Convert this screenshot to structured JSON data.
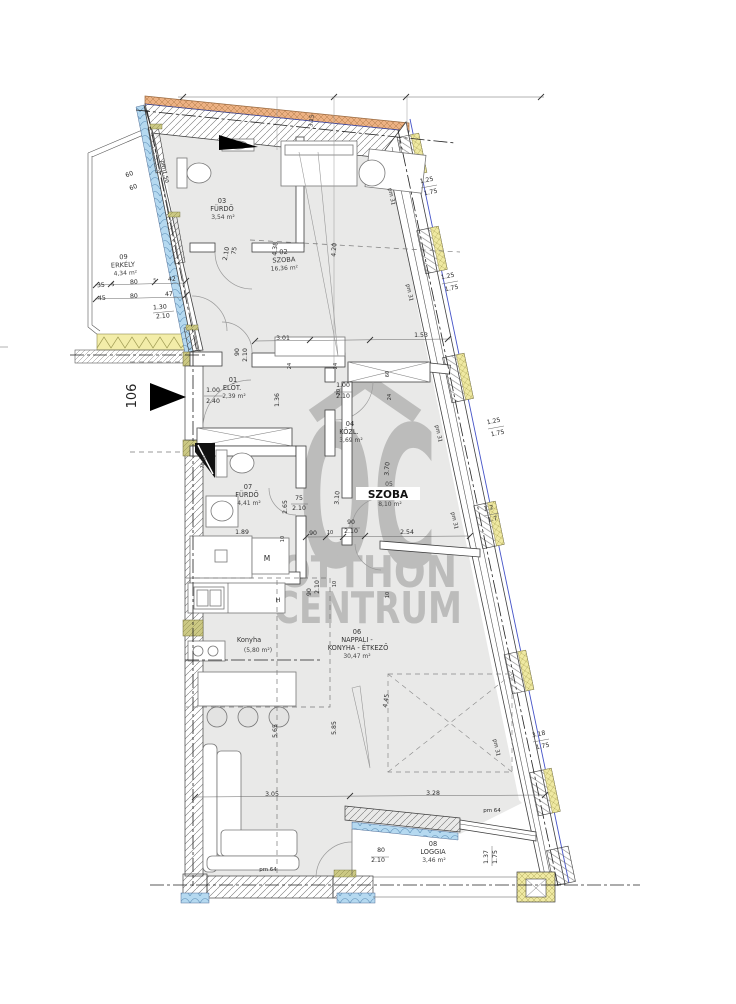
{
  "watermark": {
    "brand_top": "OC",
    "brand_mid": "OTTHON",
    "brand_bot": "CENTRUM"
  },
  "unit": {
    "number": "106"
  },
  "rooms": {
    "r01": {
      "num": "01",
      "name": "ELŐT.",
      "area": "2,39 m²"
    },
    "r02": {
      "num": "02",
      "name": "SZOBA",
      "area": "16,36 m²"
    },
    "r03": {
      "num": "03",
      "name": "FÜRDŐ",
      "area": "3,54 m²"
    },
    "r04": {
      "num": "04",
      "name": "KÖZL.",
      "area": "3,69 m²"
    },
    "r05": {
      "num": "05",
      "name": "SZOBA",
      "area": "8,10 m²"
    },
    "r06": {
      "num": "06",
      "name": "NAPPALI -",
      "name2": "KONYHA - ÉTKEZŐ",
      "area": "30,47 m²"
    },
    "r07": {
      "num": "07",
      "name": "FÜRDŐ",
      "area": "4,41 m²"
    },
    "r08": {
      "num": "08",
      "name": "LOGGIA",
      "area": "3,46 m²"
    },
    "r09": {
      "num": "09",
      "name": "ERKÉLY",
      "area": "4,34 m²"
    }
  },
  "kitchen": {
    "label": "Konyha",
    "area": "(5,80 m²)"
  },
  "appliances": {
    "washer": "M",
    "hob": "H"
  },
  "colors": {
    "room_fill": "#e9e9e8",
    "watermark": "#b5b5b4",
    "insulation_blue": "#b5d9f0",
    "insulation_yellow": "#efe9a2",
    "brick_orange": "#edb183",
    "outer_line_blue": "#4553c8"
  },
  "ann": [
    "60",
    "60",
    "pm 1.50",
    "3.15",
    "1.25",
    "1.75",
    "pm 31",
    "1.25",
    "1.75",
    "pm 31",
    "1.25",
    "1.75",
    "pm 31",
    "1.2",
    "1.7",
    "pm 31",
    "3.18",
    "1.75",
    "pm 31",
    "35",
    "5",
    "80",
    "5",
    "42",
    "45",
    "80",
    "47",
    "1.30",
    "2.10",
    "106",
    "1.00",
    "2.40",
    "90",
    "2.10",
    "3.01",
    "1.53",
    "4.38",
    "4.20",
    "75",
    "2.10",
    "1.00",
    "2.10",
    "1.36",
    "24",
    "24",
    "60",
    "20",
    "24",
    "70/50",
    "2.65",
    "75",
    "2.10",
    "1.89",
    "10",
    "3.10",
    "3.70",
    "90",
    "10",
    "90",
    "2.10",
    "2.54",
    "90",
    "2.10",
    "10",
    "10",
    "5.65",
    "5.85",
    "4.45",
    "3.05",
    "3.28",
    "pm 64",
    "pm 64",
    "80",
    "2.10",
    "1.37",
    "1.75"
  ]
}
